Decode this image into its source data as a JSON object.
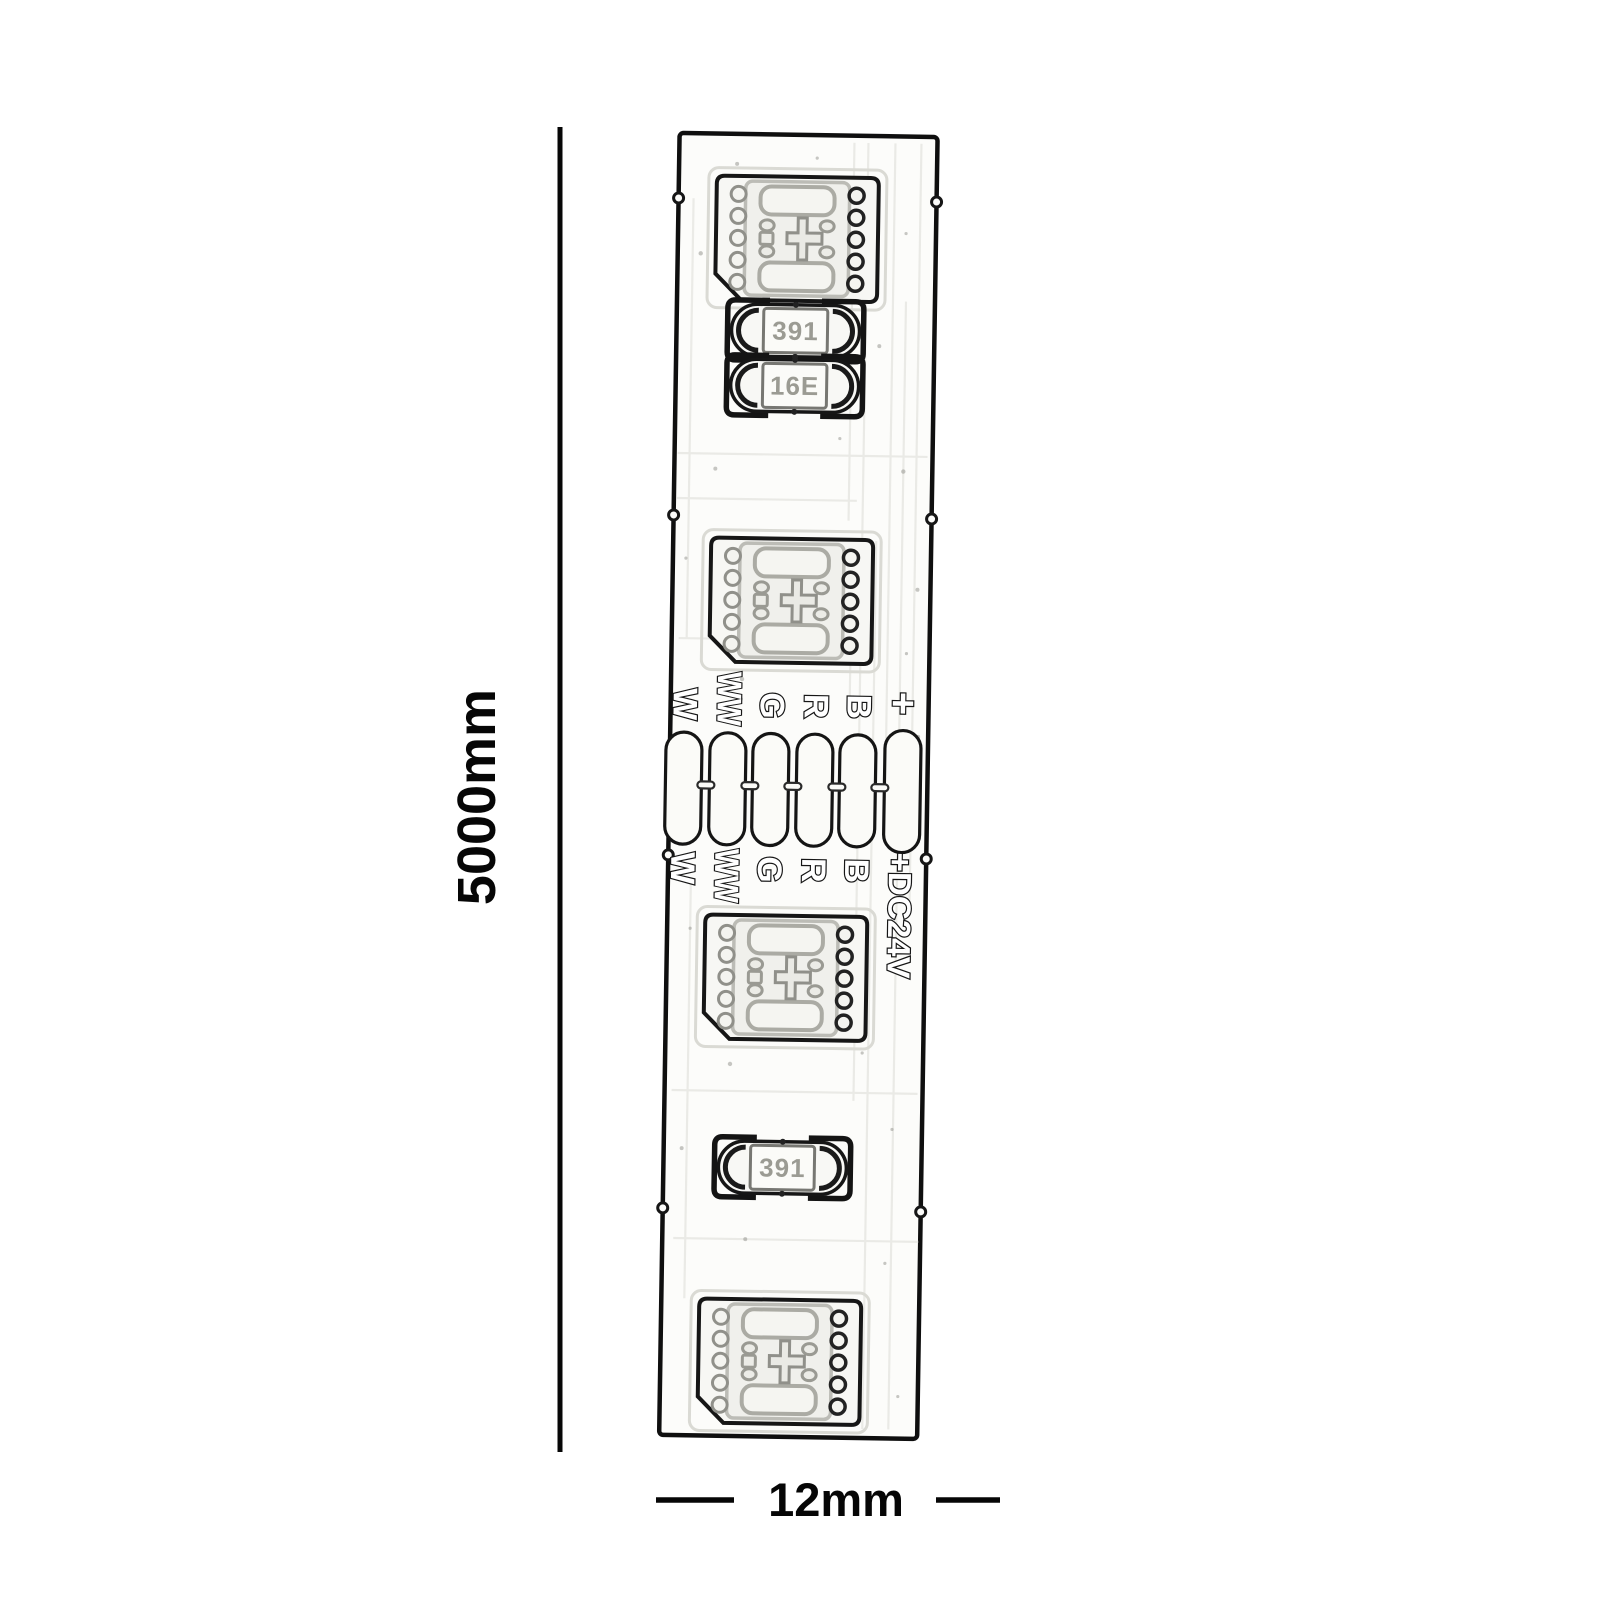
{
  "dimensions": {
    "length": "5000mm",
    "width": "12mm"
  },
  "strip": {
    "pad_labels_top": [
      "W",
      "WW",
      "G",
      "R",
      "B",
      "+"
    ],
    "pad_labels_bottom": [
      "W",
      "WW",
      "G",
      "R",
      "B",
      "+DC24V"
    ],
    "resistor_labels": {
      "top_first": "391",
      "top_second": "16E",
      "bottom": "391"
    },
    "colors": {
      "outline": "#161616",
      "board": "#fcfcfa",
      "trace": "#e8e8e3",
      "dimension": "#060606"
    }
  }
}
